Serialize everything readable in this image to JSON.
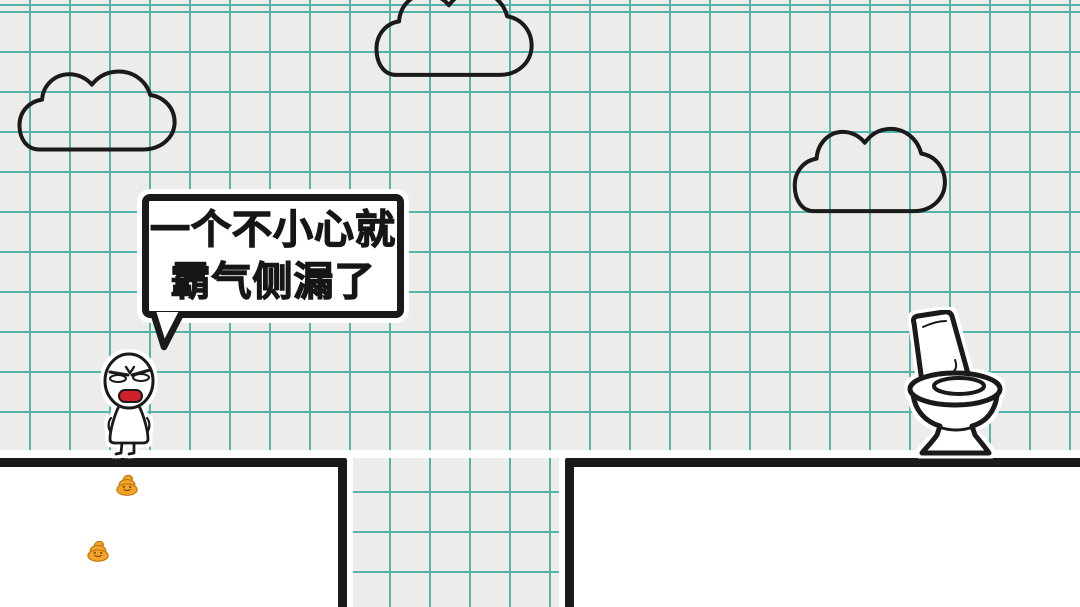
{
  "scene": {
    "name": "hand-drawn-toilet-puzzle-level",
    "style": "graph-paper doodle"
  },
  "speech_bubble": {
    "line1": "一个不小心就",
    "line2": "霸气侧漏了"
  },
  "objects": {
    "character": "angry-stick-figure",
    "toilet": "open-lid-toilet",
    "poop_count": 2,
    "cloud_count": 3,
    "platforms": [
      "left-platform",
      "right-platform"
    ]
  },
  "palette": {
    "background": "#ECECEA",
    "grid_line": "#57B4AB",
    "ink": "#1A1A1A",
    "mouth_red": "#D2202A",
    "poop_body": "#F4A42A",
    "poop_outline": "#C47B0E",
    "platform_fill": "#FFFFFF"
  }
}
